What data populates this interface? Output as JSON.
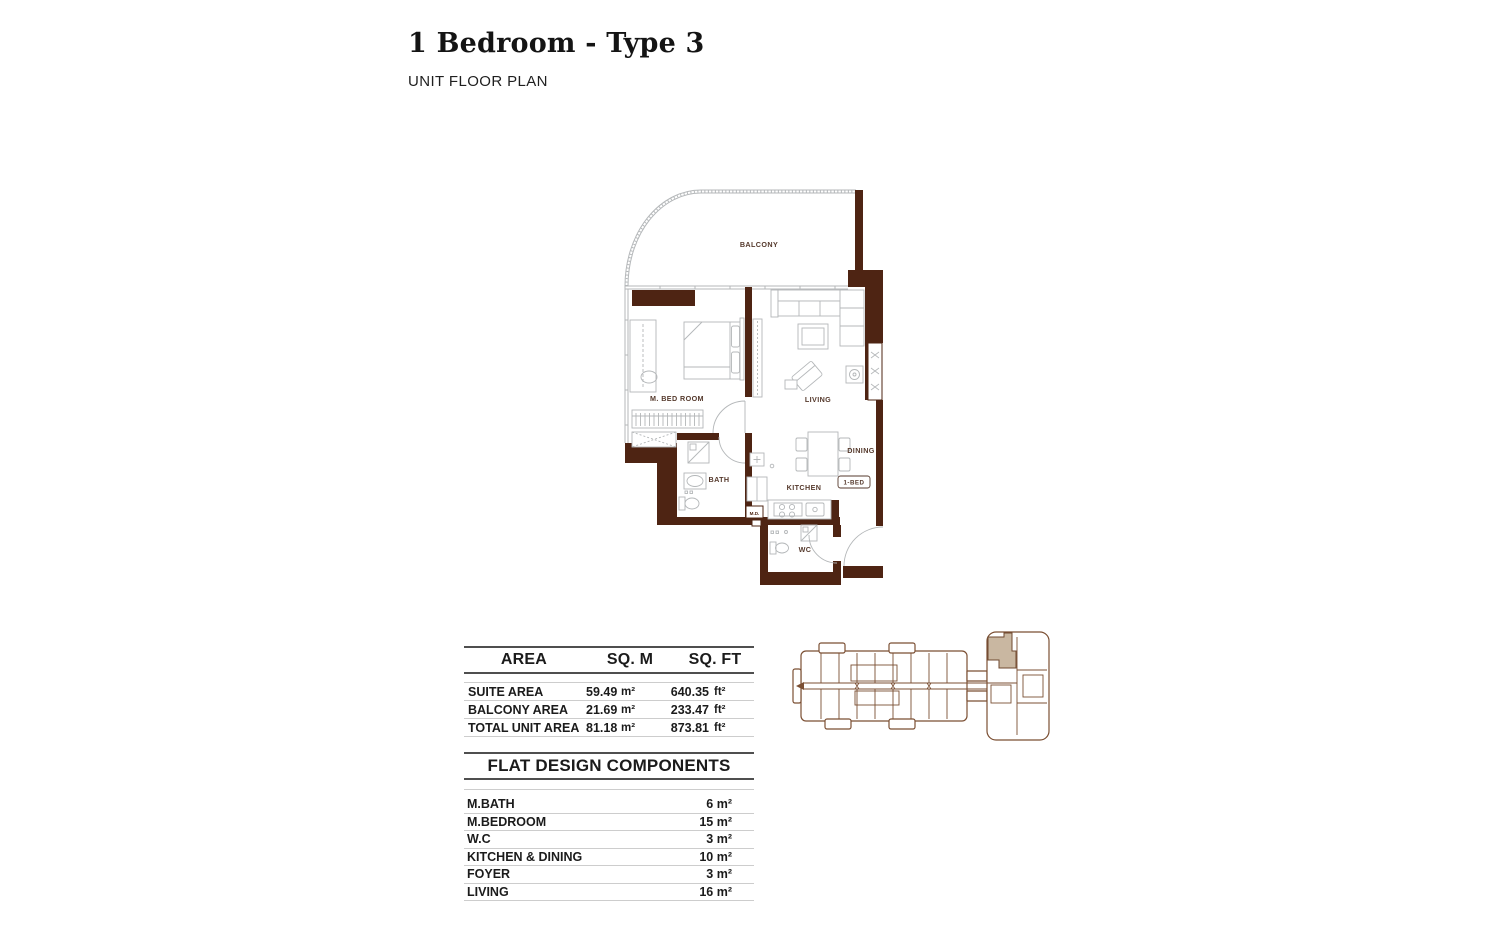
{
  "header": {
    "title": "1 Bedroom - Type 3",
    "subtitle": "UNIT FLOOR PLAN"
  },
  "floor_plan": {
    "labels": {
      "balcony": "BALCONY",
      "master_bedroom": "M. BED ROOM",
      "living": "LIVING",
      "dining": "DINING",
      "kitchen": "KITCHEN",
      "bath": "BATH",
      "wc": "WC",
      "meter_duct": "M.D.",
      "unit_type_badge": "1-BED"
    },
    "colors": {
      "wall": "#4e2413",
      "room_label": "#55392c",
      "drawing_line": "#b4b7b9"
    }
  },
  "area_table": {
    "col_area": "AREA",
    "col_sqm": "SQ. M",
    "col_sqft": "SQ. FT",
    "rows": [
      {
        "label": "SUITE AREA",
        "sqm": "59.49",
        "sqm_unit": "m²",
        "sqft": "640.35",
        "sqft_unit": "ft²"
      },
      {
        "label": "BALCONY AREA",
        "sqm": "21.69",
        "sqm_unit": "m²",
        "sqft": "233.47",
        "sqft_unit": "ft²"
      },
      {
        "label": "TOTAL UNIT AREA",
        "sqm": "81.18",
        "sqm_unit": "m²",
        "sqft": "873.81",
        "sqft_unit": "ft²"
      }
    ]
  },
  "components_table": {
    "title": "FLAT DESIGN COMPONENTS",
    "rows": [
      {
        "label": "M.BATH",
        "value": "6 m²"
      },
      {
        "label": "M.BEDROOM",
        "value": "15 m²"
      },
      {
        "label": "W.C",
        "value": "3 m²"
      },
      {
        "label": "KITCHEN & DINING",
        "value": "10 m²"
      },
      {
        "label": "FOYER",
        "value": "3 m²"
      },
      {
        "label": "LIVING",
        "value": "16 m²"
      }
    ]
  },
  "key_plan": {
    "highlight_color": "#c9b7a1",
    "line_color": "#7b4f33"
  }
}
